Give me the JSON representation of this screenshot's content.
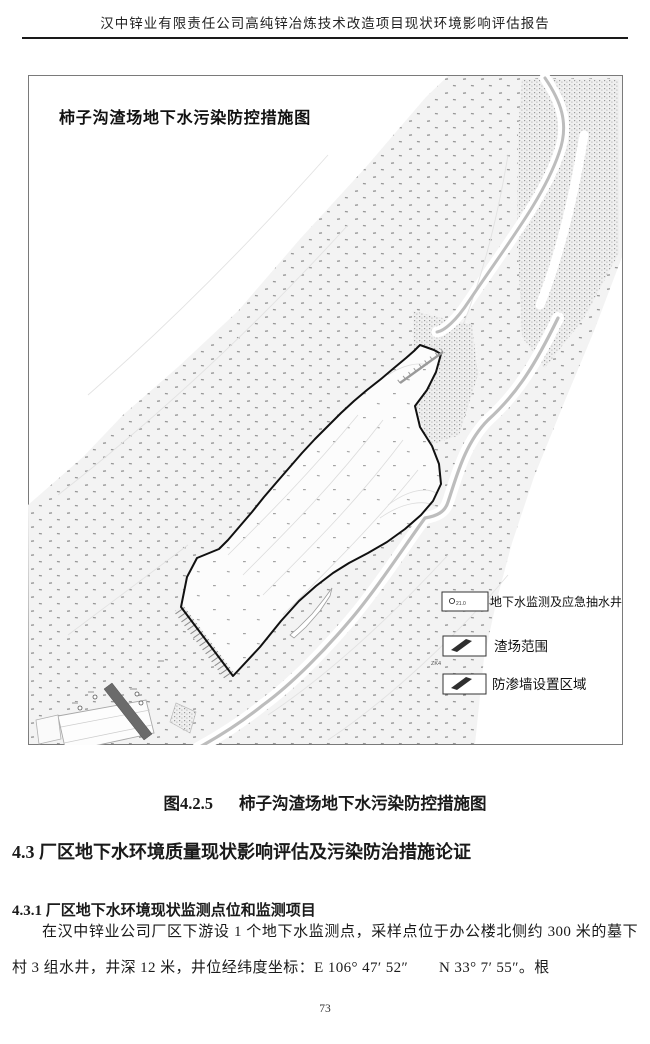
{
  "page": {
    "header": "汉中锌业有限责任公司高纯锌冶炼技术改造项目现状环境影响评估报告",
    "page_number": "73"
  },
  "figure": {
    "map_title": "柿子沟渣场地下水污染防控措施图",
    "legend": [
      {
        "label": "地下水监测及应急抽水井",
        "well_value": "21.0"
      },
      {
        "label": "渣场范围"
      },
      {
        "label": "防渗墙设置区域",
        "marker": "ZK4"
      }
    ],
    "caption_number": "图4.2.5",
    "caption_title": "柿子沟渣场地下水污染防控措施图"
  },
  "sections": {
    "h2": "4.3 厂区地下水环境质量现状影响评估及污染防治措施论证",
    "h3": "4.3.1 厂区地下水环境现状监测点位和监测项目",
    "paragraph": "在汉中锌业公司厂区下游设 1 个地下水监测点，采样点位于办公楼北侧约 300 米的墓下村 3 组水井，井深 12 米，井位经纬度坐标：E 106° 47′ 52″　　N 33° 7′ 55″。根"
  },
  "colors": {
    "text": "#1a1a1a",
    "map_border": "#7a7a7a",
    "terrain_dot": "#8e8e8e",
    "road": "#bdbdbd",
    "dam_fill": "#6b6b6b",
    "boundary": "#111111"
  }
}
